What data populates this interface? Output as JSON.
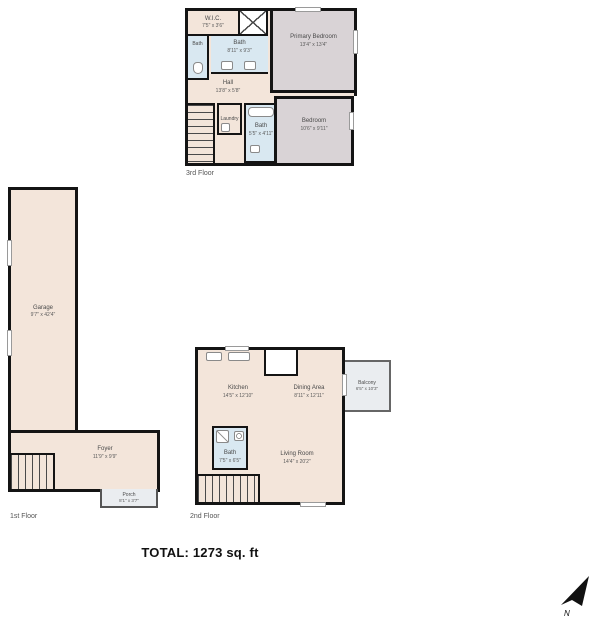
{
  "floors": {
    "third": {
      "label": "3rd Floor",
      "rooms": {
        "wic": {
          "name": "W.I.C.",
          "dims": "7'5\" x 3'6\""
        },
        "bath_small": {
          "name": "Bath",
          "dims": ""
        },
        "bath_main": {
          "name": "Bath",
          "dims": "8'11\" x 9'3\""
        },
        "primary_bedroom": {
          "name": "Primary Bedroom",
          "dims": "13'4\" x 13'4\""
        },
        "hall": {
          "name": "Hall",
          "dims": "13'8\" x 5'8\""
        },
        "laundry": {
          "name": "Laundry",
          "dims": ""
        },
        "bath2": {
          "name": "Bath",
          "dims": "5'5\" x 4'11\""
        },
        "bedroom": {
          "name": "Bedroom",
          "dims": "10'6\" x 9'11\""
        }
      }
    },
    "first": {
      "label": "1st Floor",
      "rooms": {
        "garage": {
          "name": "Garage",
          "dims": "9'7\" x 42'4\""
        },
        "foyer": {
          "name": "Foyer",
          "dims": "11'9\" x 9'9\""
        },
        "porch": {
          "name": "Porch",
          "dims": "8'1\" x 3'7\""
        }
      }
    },
    "second": {
      "label": "2nd Floor",
      "rooms": {
        "kitchen": {
          "name": "Kitchen",
          "dims": "14'5\" x 12'10\""
        },
        "dining": {
          "name": "Dining Area",
          "dims": "8'11\" x 12'11\""
        },
        "balcony": {
          "name": "Balcony",
          "dims": "6'5\" x 10'3\""
        },
        "bath": {
          "name": "Bath",
          "dims": "7'5\" x 6'5\""
        },
        "living": {
          "name": "Living Room",
          "dims": "14'4\" x 20'2\""
        }
      }
    }
  },
  "total": {
    "label": "TOTAL:",
    "value": "1273 sq. ft"
  },
  "compass": {
    "label": "N"
  },
  "colors": {
    "wall": "#141414",
    "floor": "#f3e5da",
    "bath": "#d9e8f1",
    "bedroom": "#d9d3d6",
    "outdoor": "#eaedf0"
  }
}
